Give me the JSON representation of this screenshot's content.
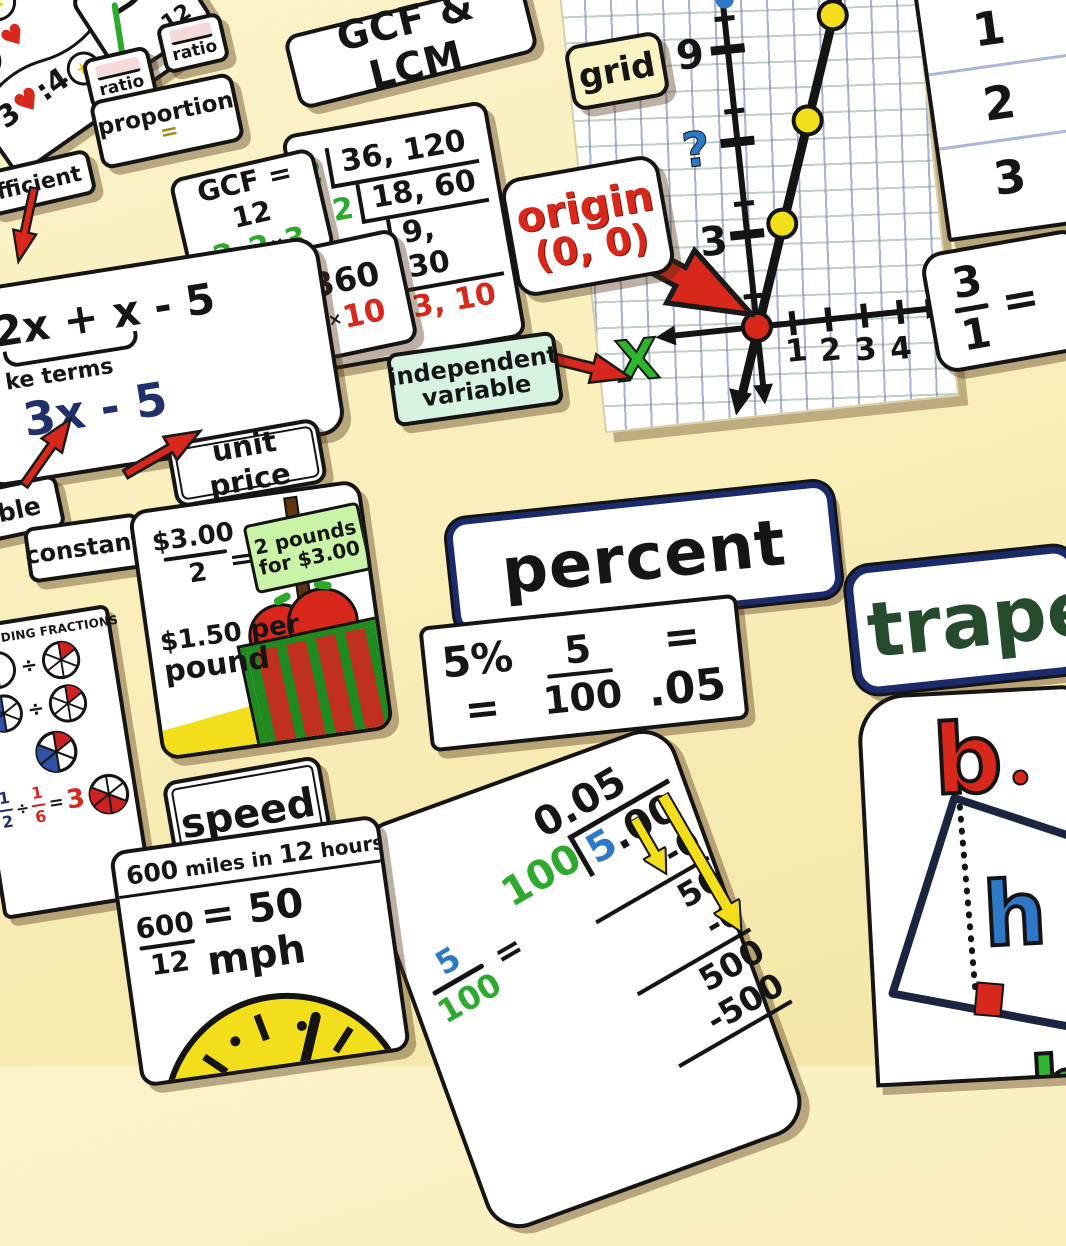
{
  "palette": {
    "wall": "#f8efbb",
    "red": "#d8281c",
    "green": "#2daa2d",
    "navy": "#20306b",
    "blue": "#2e78c8",
    "yellow": "#f2de1a",
    "mint": "#d6f3e2",
    "pink": "#f6d9da",
    "dark_green": "#254b2c",
    "crate_green": "#1f8a1f"
  },
  "icons": {
    "star": "★",
    "heart": "♥"
  },
  "stars_card": {
    "ratio_n1": "3",
    "ratio_sym1": "♥",
    "ratio_colon": ":",
    "ratio_n2": "4",
    "ratio_sym2": "★"
  },
  "reduce_card": {
    "text": "12"
  },
  "ratio_a": "ratio",
  "ratio_b": "ratio",
  "proportion": {
    "label": "proportion",
    "equals": "="
  },
  "gcf_lcm": {
    "title": "GCF & LCM",
    "times": "×",
    "ladder": {
      "r1d": "2",
      "r1v": "36, 120",
      "r2d": "2",
      "r2v": "18, 60",
      "r3d": "3",
      "r3v": "9, 30",
      "result": "3, 10"
    },
    "gcf": {
      "heading": "GCF = 12",
      "f1": "2",
      "f2": "2",
      "f3": "3"
    },
    "lcm": {
      "heading": "LCM = 360",
      "f1": "2",
      "f2": "2",
      "f3": "3",
      "f4": "3",
      "f5": "10"
    }
  },
  "coefficient_label": "fficient",
  "expression": {
    "line1": "2x + x - 5",
    "like_terms": "ke terms",
    "result": "3x - 5"
  },
  "variable_label": "ble",
  "constant_label": "constant",
  "unit_price": {
    "label": "unit price",
    "num": "$3.00",
    "den": "2",
    "equals": "=",
    "sign_line1": "2 pounds",
    "sign_line2": "for $3.00",
    "rate_line1": "$1.50 per",
    "rate_line2": "pound"
  },
  "grid_label": "grid",
  "graph": {
    "y9": "9",
    "y_question": "?",
    "y3": "3",
    "x1": "1",
    "x2": "2",
    "x3": "3",
    "x4": "4",
    "x_axis_label": "X"
  },
  "origin_label": {
    "word": "origin",
    "coords": "(0, 0)"
  },
  "independent_label": {
    "line1": "independent",
    "line2": "variable"
  },
  "number_list": {
    "n1": "1",
    "n2": "2",
    "n3": "3"
  },
  "fraction_eq": {
    "num": "3",
    "den": "1",
    "equals": "="
  },
  "percent": {
    "label": "percent",
    "lhs": "5% =",
    "num": "5",
    "den": "100",
    "rhs": "= .05"
  },
  "division": {
    "num": "5",
    "den": "100",
    "equals": "=",
    "quotient": "0.05",
    "divisor": "100",
    "dividend_lead": "5",
    "dividend_rest": ".00",
    "step1": "-0",
    "step2": "50",
    "step3": "-0",
    "step4": "500",
    "step5": "-500"
  },
  "trapezoid": {
    "title": "trape",
    "b1": "b",
    "h": "h",
    "b2": "b"
  },
  "dividing_fractions": {
    "title": "DIVIDING FRACTIONS",
    "op1": "÷",
    "op2": "÷",
    "f1n": "1",
    "f1d": "2",
    "op": "÷",
    "f2n": "1",
    "f2d": "6",
    "equals": "=",
    "result": "3"
  },
  "speed": {
    "label": "speed",
    "head_b1": "600",
    "head_t1": " miles in ",
    "head_b2": "12",
    "head_t2": " hours",
    "num": "600",
    "den": "12",
    "result": "= 50 mph"
  }
}
